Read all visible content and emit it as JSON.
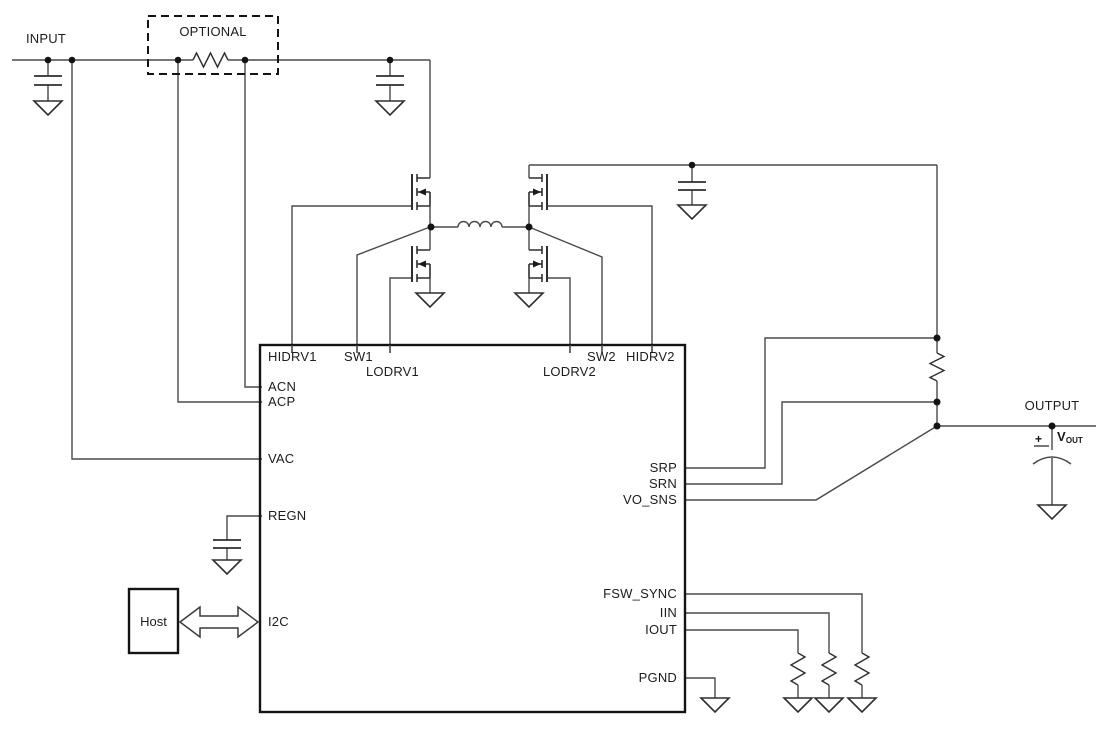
{
  "colors": {
    "background": "#ffffff",
    "wire": "#4a4a4a",
    "component_outline": "#2f2f2f",
    "box_outline": "#141414",
    "text": "#1c1c1c"
  },
  "labels": {
    "input": "INPUT",
    "optional": "OPTIONAL",
    "output": "OUTPUT",
    "host": "Host",
    "vout_plus": "+",
    "vout_v": "V",
    "vout_sub": "OUT"
  },
  "ic": {
    "pins": {
      "hidrv1": "HIDRV1",
      "sw1": "SW1",
      "lodrv1": "LODRV1",
      "lodrv2": "LODRV2",
      "sw2": "SW2",
      "hidrv2": "HIDRV2",
      "acn": "ACN",
      "acp": "ACP",
      "vac": "VAC",
      "regn": "REGN",
      "i2c": "I2C",
      "srp": "SRP",
      "srn": "SRN",
      "vo_sns": "VO_SNS",
      "fsw_sync": "FSW_SYNC",
      "iin": "IIN",
      "iout": "IOUT",
      "pgnd": "PGND"
    }
  }
}
